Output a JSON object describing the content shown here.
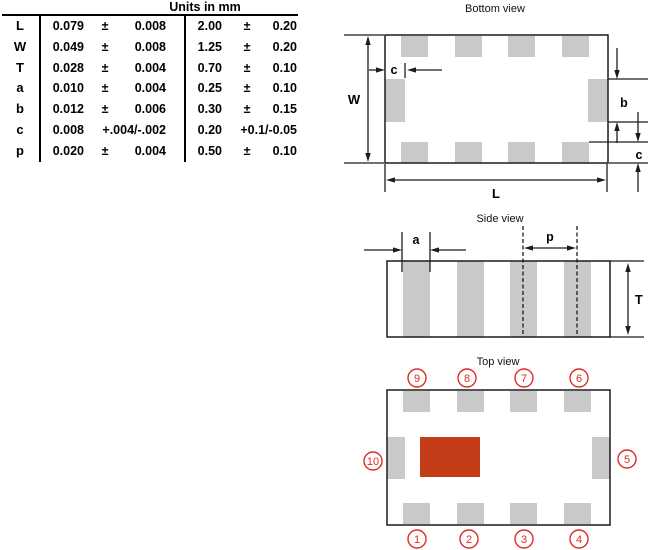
{
  "units_header": "Units in mm",
  "table": {
    "rows": [
      {
        "label": "L",
        "v1": "0.079",
        "pm1": "±",
        "t1": "0.008",
        "v2": "2.00",
        "pm2": "±",
        "t2": "0.20"
      },
      {
        "label": "W",
        "v1": "0.049",
        "pm1": "±",
        "t1": "0.008",
        "v2": "1.25",
        "pm2": "±",
        "t2": "0.20"
      },
      {
        "label": "T",
        "v1": "0.028",
        "pm1": "±",
        "t1": "0.004",
        "v2": "0.70",
        "pm2": "±",
        "t2": "0.10"
      },
      {
        "label": "a",
        "v1": "0.010",
        "pm1": "±",
        "t1": "0.004",
        "v2": "0.25",
        "pm2": "±",
        "t2": "0.10"
      },
      {
        "label": "b",
        "v1": "0.012",
        "pm1": "±",
        "t1": "0.006",
        "v2": "0.30",
        "pm2": "±",
        "t2": "0.15"
      },
      {
        "label": "c",
        "v1": "0.008",
        "pm1": "",
        "t1": "+.004/-.002",
        "v2": "0.20",
        "pm2": "",
        "t2": "+0.1/-0.05"
      },
      {
        "label": "p",
        "v1": "0.020",
        "pm1": "±",
        "t1": "0.004",
        "v2": "0.50",
        "pm2": "±",
        "t2": "0.10"
      }
    ]
  },
  "views": {
    "bottom": {
      "title": "Bottom view",
      "labels": {
        "W": "W",
        "L": "L",
        "c_top": "c",
        "b": "b",
        "c_right": "c"
      }
    },
    "side": {
      "title": "Side view",
      "labels": {
        "a": "a",
        "p": "p",
        "T": "T"
      }
    },
    "top": {
      "title": "Top view",
      "pins": [
        "1",
        "2",
        "3",
        "4",
        "5",
        "6",
        "7",
        "8",
        "9",
        "10"
      ]
    }
  },
  "colors": {
    "pad_gray": "#c9c9c9",
    "line": "#1c1c1c",
    "marking_red": "#c23d18",
    "pin_red": "#dd2c23"
  }
}
